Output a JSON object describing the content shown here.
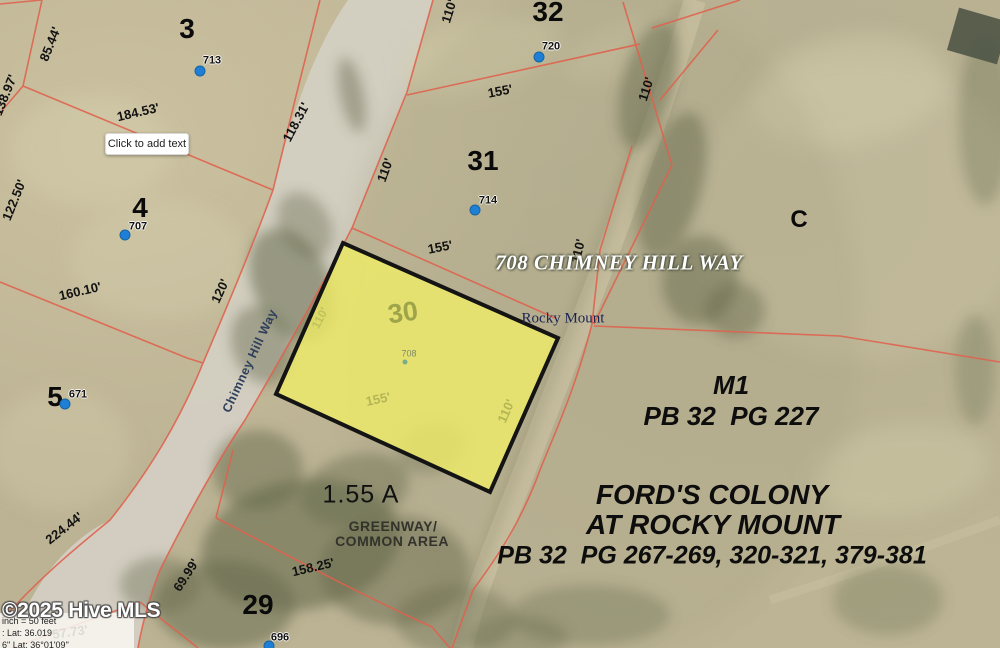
{
  "watermark": "©2025 Hive MLS",
  "annotation_box": "Click to add text",
  "address": "708 CHIMNEY HILL WAY",
  "place": "Rocky Mount",
  "street": "Chimney Hill Way",
  "section": "C",
  "zoning": {
    "code": "M1",
    "plat": "PB 32  PG 227"
  },
  "subdivision": {
    "line1": "FORD'S COLONY",
    "line2": "AT ROCKY MOUNT",
    "line3": "PB 32  PG 267-269, 320-321, 379-381"
  },
  "greenway": {
    "line1": "GREENWAY/",
    "line2": "COMMON AREA"
  },
  "highlight": {
    "lot": "30",
    "parcel": "708",
    "area": "1.55 A",
    "dim_front": "155'",
    "dim_side": "110'",
    "dim_side2": "110'"
  },
  "info": {
    "line1": "inch = 50 feet",
    "line2": ": Lat: 36.019",
    "line3": "6\" Lat: 36°01'09\""
  },
  "lots": [
    {
      "n": "3"
    },
    {
      "n": "4"
    },
    {
      "n": "5"
    },
    {
      "n": "29"
    },
    {
      "n": "31"
    },
    {
      "n": "32"
    }
  ],
  "markers": [
    {
      "id": "713"
    },
    {
      "id": "720"
    },
    {
      "id": "714"
    },
    {
      "id": "707"
    },
    {
      "id": "671"
    },
    {
      "id": "696"
    }
  ],
  "dims": [
    {
      "t": "85.44'"
    },
    {
      "t": "138.97'"
    },
    {
      "t": "184.53'"
    },
    {
      "t": "118.31'"
    },
    {
      "t": "122.50'"
    },
    {
      "t": "160.10'"
    },
    {
      "t": "120'"
    },
    {
      "t": "110'"
    },
    {
      "t": "155'"
    },
    {
      "t": "110'"
    },
    {
      "t": "110'"
    },
    {
      "t": "155'"
    },
    {
      "t": "110'"
    },
    {
      "t": "224.44'"
    },
    {
      "t": "69.99'"
    },
    {
      "t": "158.25'"
    },
    {
      "t": "57.73'"
    }
  ],
  "colors": {
    "parcel_line": "#e0614d",
    "highlight_fill": "#f0ed68",
    "highlight_border": "#141414",
    "marker_blue": "#1f7fd6",
    "road": "#d3cfc2"
  }
}
